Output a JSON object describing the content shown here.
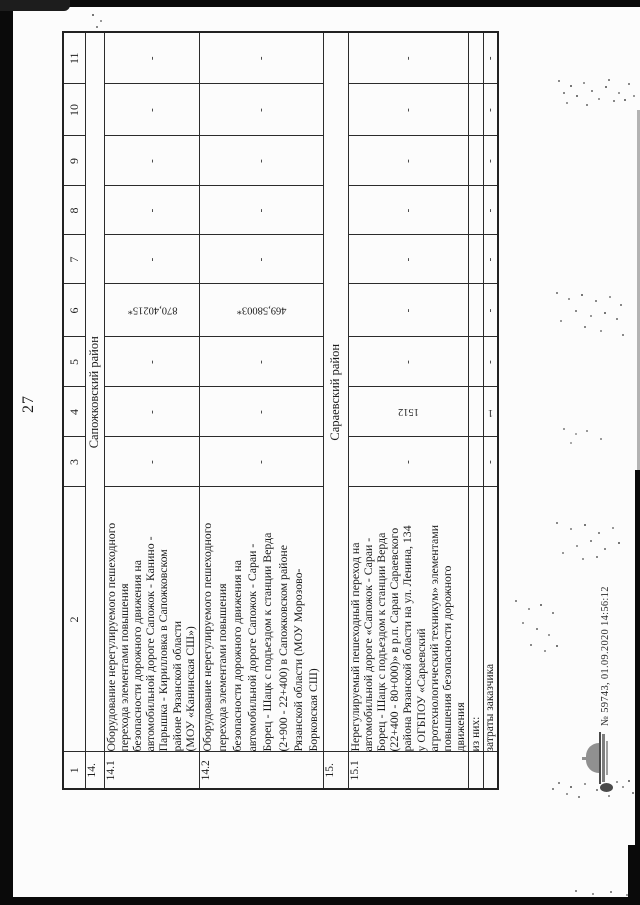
{
  "page_number": "27",
  "table": {
    "header": [
      "1",
      "2",
      "3",
      "4",
      "5",
      "6",
      "7",
      "8",
      "9",
      "10",
      "11"
    ],
    "row14": {
      "num": "14.",
      "section": "Сапожковский район"
    },
    "row141": {
      "num": "14.1",
      "text": "Оборудование нерегулируемого пешеходного\nперехода элементами повышения\nбезопасности дорожного движения на\nавтомобильной дороге Сапожок - Канино -\nПарышка - Кирилловка в Сапожковском\nрайоне Рязанской области\n(МОУ «Канинская СШ»)",
      "c3": "-",
      "c4": "-",
      "c5": "-",
      "c6": "870,40215*",
      "c7": "-",
      "c8": "-",
      "c9": "-",
      "c10": "-",
      "c11": "-"
    },
    "row142": {
      "num": "14.2",
      "text": "Оборудование нерегулируемого пешеходного\nперехода элементами повышения\nбезопасности дорожного движения на\nавтомобильной дороге Сапожок - Сараи -\nБорец - Шацк с подъездом к станции Верда\n(2+900 - 22+400) в Сапожковском районе\nРязанской области (МОУ Морозово-\nБорковская СШ)",
      "c3": "-",
      "c4": "-",
      "c5": "-",
      "c6": "469,58003*",
      "c7": "-",
      "c8": "-",
      "c9": "-",
      "c10": "-",
      "c11": "-"
    },
    "row15": {
      "num": "15.",
      "section": "Сараевский район"
    },
    "row151": {
      "num": "15.1",
      "text": "Нерегулируемый пешеходный переход на\nавтомобильной дороге «Сапожок - Сараи -\nБорец - Шацк с подъездом к станции Верда\n(22+400 - 80+000)» в р.п. Сараи Сараевского\nрайона Рязанской области на ул. Ленина, 134\nу ОГБПОУ «Сараевский\nагротехнологический техникум» элементами\nповышения безопасности дорожного\nдвижения",
      "c3": "-",
      "c4": "1512",
      "c5": "-",
      "c6": "-",
      "c7": "-",
      "c8": "-",
      "c9": "-",
      "c10": "-",
      "c11": "-"
    },
    "row_iznikh": {
      "label": "из них:"
    },
    "row_zatraty": {
      "label": "затраты заказчика",
      "c3": "-",
      "c4": "1",
      "c5": "-",
      "c6": "-",
      "c7": "-",
      "c8": "-",
      "c9": "-",
      "c10": "-",
      "c11": "-"
    }
  },
  "stamp": {
    "text": "№ 59743, 01.09.2020 14:56:12"
  }
}
